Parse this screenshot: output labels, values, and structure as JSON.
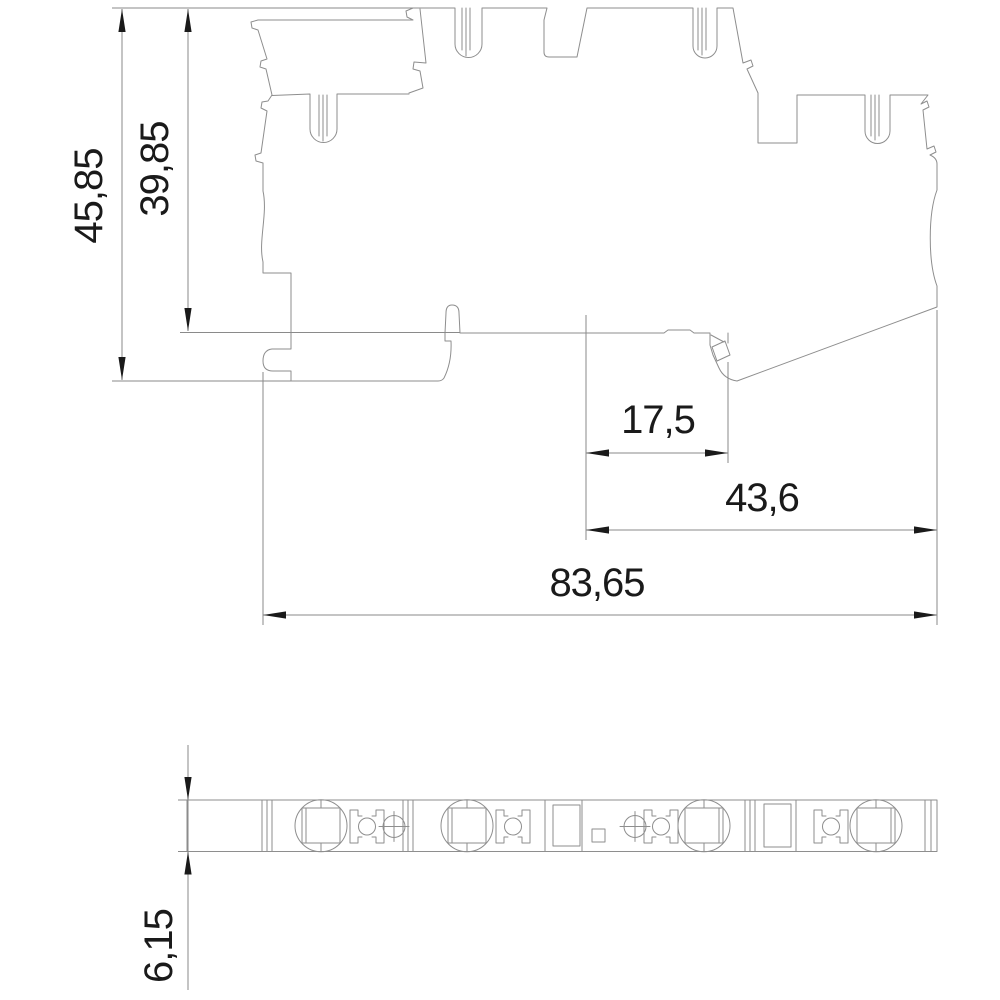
{
  "drawing": {
    "colors": {
      "background": "#ffffff",
      "geometry_lines": "#8e8e8e",
      "dimension_lines": "#8a8a8a",
      "text_and_arrows": "#1a1a1a"
    },
    "dimensions": {
      "total_height": "45,85",
      "body_height": "39,85",
      "latch_offset": "17,5",
      "right_section_width": "43,6",
      "total_width": "83,65",
      "base_thickness": "6,15"
    }
  }
}
